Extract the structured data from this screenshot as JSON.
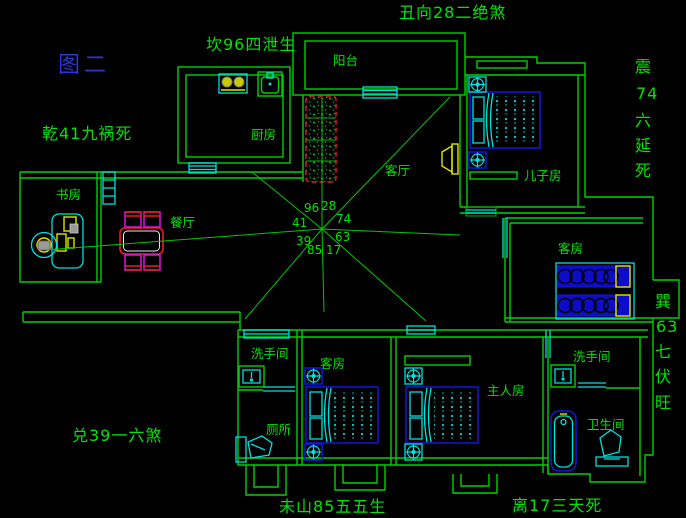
{
  "figure": {
    "label": "图二"
  },
  "annotations": {
    "north_left": {
      "text": "坎96四泄生"
    },
    "north": {
      "text": "丑向28二绝煞"
    },
    "northwest": {
      "text": "乾41九祸死"
    },
    "east_upper": {
      "text": "震74六延死",
      "chars": [
        "震",
        "74",
        "六",
        "延",
        "死"
      ]
    },
    "east_lower": {
      "text": "巽63七伏旺",
      "chars": [
        "巽",
        "63",
        "七",
        "伏",
        "旺"
      ]
    },
    "southwest": {
      "text": "兑39一六煞"
    },
    "south": {
      "text": "未山85五五生"
    },
    "southeast": {
      "text": "离17三天死"
    }
  },
  "compass": {
    "numbers": {
      "nw": "41",
      "n_left": "96",
      "n_right": "28",
      "ne": "74",
      "w": "39",
      "e": "63",
      "s_left": "85",
      "s_right": "17"
    }
  },
  "rooms": {
    "balcony": "阳台",
    "kitchen": "厨房",
    "living": "客厅",
    "son": "儿子房",
    "study": "书房",
    "dining": "餐厅",
    "guest_east": "客房",
    "washroom_sw": "洗手间",
    "toilet_sw": "厕所",
    "guest_south": "客房",
    "master": "主人房",
    "washroom_se": "洗手间",
    "bathroom_se": "卫生间"
  },
  "colors": {
    "background": "#000000",
    "wall_green": "#00d200",
    "text_green": "#00e400",
    "fixture_cyan": "#00e2e2",
    "bed_blue": "#1414e6",
    "table_red": "#e81e1e",
    "chair_magenta": "#e014e0",
    "appliance_yellow": "#e2e200",
    "figure_blue": "#2b36d8"
  }
}
